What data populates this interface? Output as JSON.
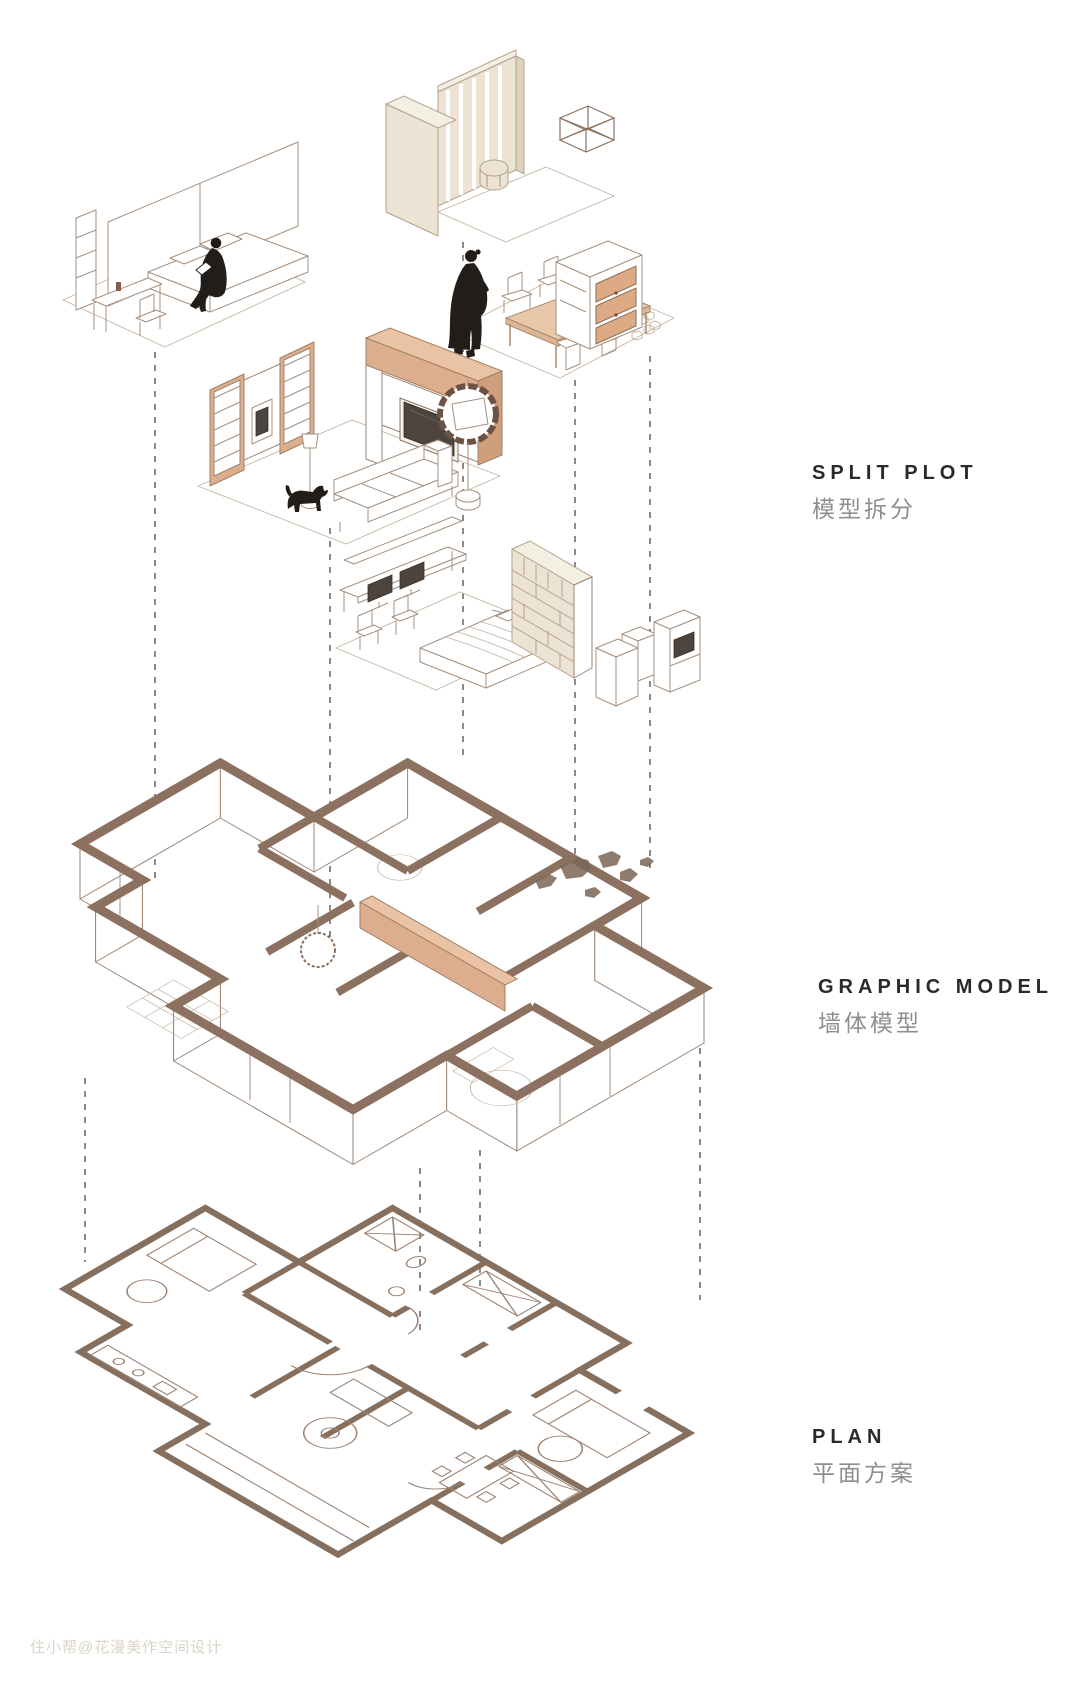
{
  "canvas": {
    "width": 1080,
    "height": 1688,
    "background": "#ffffff"
  },
  "labels": {
    "split_plot": {
      "en": "SPLIT PLOT",
      "zh": "模型拆分"
    },
    "graphic_model": {
      "en": "GRAPHIC MODEL",
      "zh": "墙体模型"
    },
    "plan": {
      "en": "PLAN",
      "zh": "平面方案"
    }
  },
  "watermark": {
    "text": "住小帮@花漫美作空间设计"
  },
  "colors": {
    "accent_tan": "#dcae8e",
    "accent_tan_light": "#e9c3a3",
    "wall_brown": "#8d7160",
    "plan_wall_brown": "#876f5e",
    "cream_wall": "#ece3d4",
    "sketch_line": "#a5907f",
    "silhouette_black": "#221d19",
    "dash_line": "#4a4a4a"
  },
  "icons": [
    "person-sitting-icon",
    "person-standing-icon",
    "dog-icon"
  ]
}
